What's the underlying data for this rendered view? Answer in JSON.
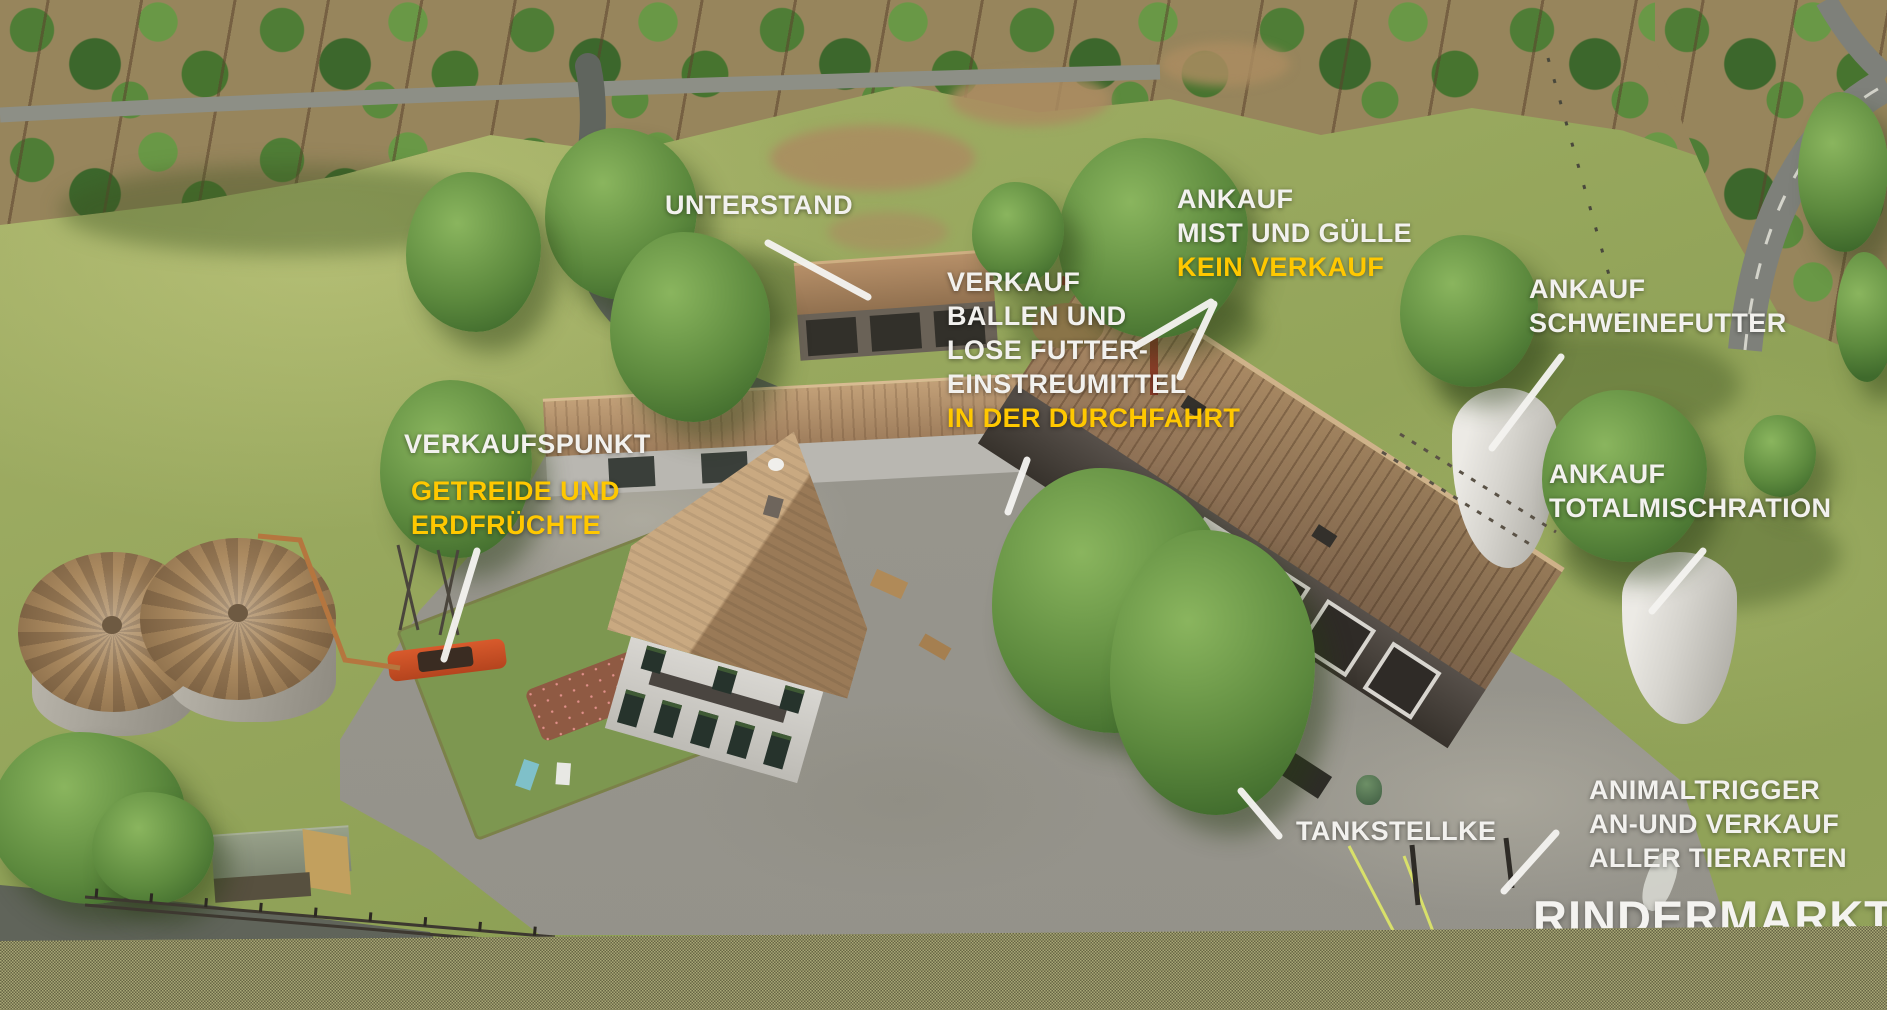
{
  "watermark": {
    "text": "RINDERMARKT"
  },
  "colors": {
    "label_white": "#f2f1ee",
    "label_yellow": "#ffc800",
    "pointer_line": "#f4f3f0",
    "dither_band": "#a8a776"
  },
  "labels": {
    "unterstand": {
      "line1": "UNTERSTAND"
    },
    "mist_guelle": {
      "line1": "ANKAUF",
      "line2": "MIST UND GÜLLE",
      "line3": "KEIN VERKAUF"
    },
    "verkauf_ballen": {
      "line1": "VERKAUF",
      "line2": "BALLEN UND",
      "line3": "LOSE FUTTER-",
      "line4": "EINSTREUMITTEL",
      "line5": "IN DER DURCHFAHRT"
    },
    "schweinefutter": {
      "line1": "ANKAUF",
      "line2": "SCHWEINEFUTTER"
    },
    "totalmischration": {
      "line1": "ANKAUF",
      "line2": "TOTALMISCHRATION"
    },
    "verkaufspunkt": {
      "line1": "VERKAUFSPUNKT",
      "line2": "GETREIDE UND",
      "line3": "ERDFRÜCHTE"
    },
    "tankstelle": {
      "line1": "TANKSTELLKE"
    },
    "animaltrigger": {
      "line1": "ANIMALTRIGGER",
      "line2": "AN-UND VERKAUF",
      "line3": "ALLER TIERARTEN"
    }
  }
}
